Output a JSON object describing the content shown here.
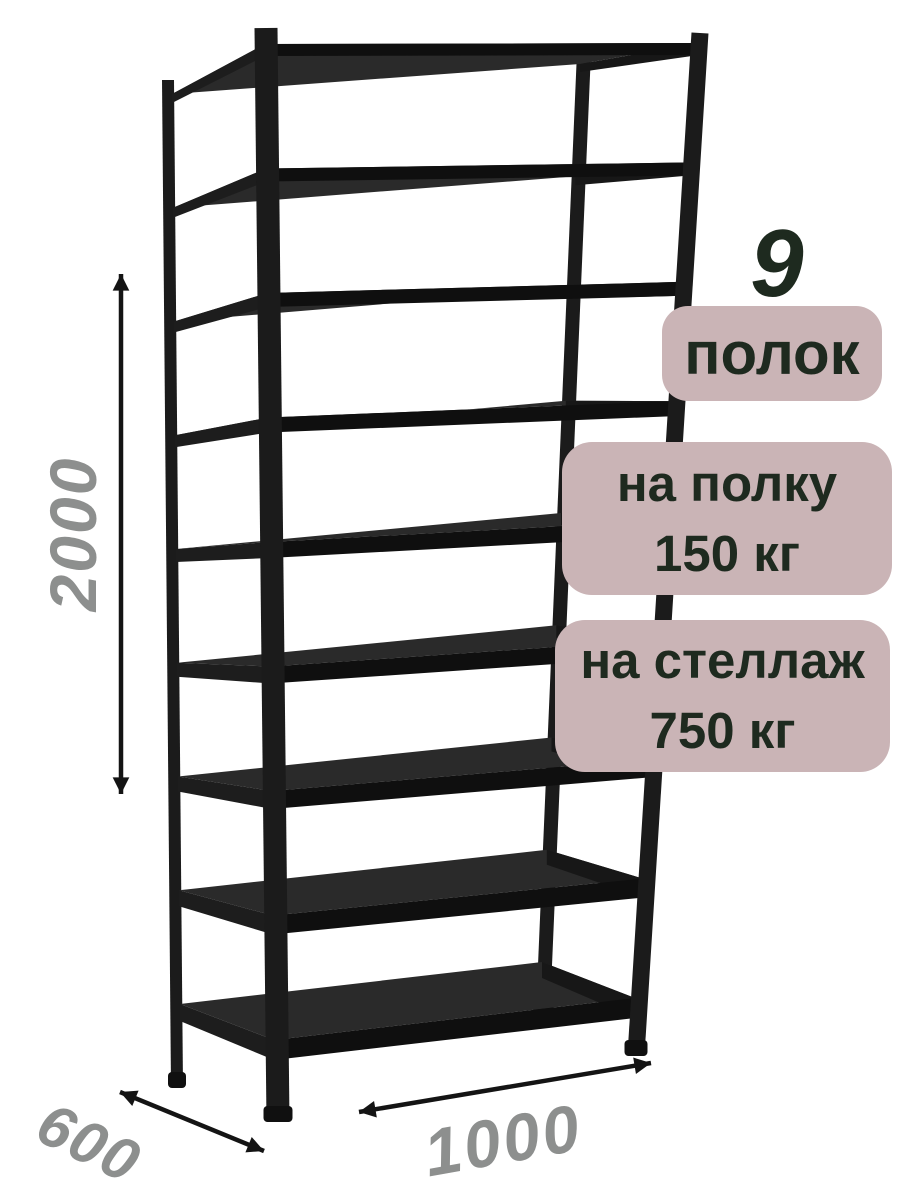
{
  "page": {
    "background": "#ffffff"
  },
  "badges": {
    "count_number": "9",
    "count_label": "полок",
    "shelf_load_line1": "на полку",
    "shelf_load_line2": "150 кг",
    "rack_load_line1": "на стеллаж",
    "rack_load_line2": "750 кг",
    "badge_bg": "#cab4b6",
    "text_color": "#1e2a1f"
  },
  "dimensions": {
    "height_mm": "2000",
    "depth_mm": "600",
    "width_mm": "1000",
    "label_color": "#8d8f8e",
    "arrow_color": "#141414"
  },
  "product": {
    "shelf_count": 9,
    "frame_color": "#1b1b1b",
    "shelf_top_color": "#2a2a2a",
    "shelf_edge_color": "#0f0f0f",
    "shelf_side_color": "#1d1d1d"
  }
}
